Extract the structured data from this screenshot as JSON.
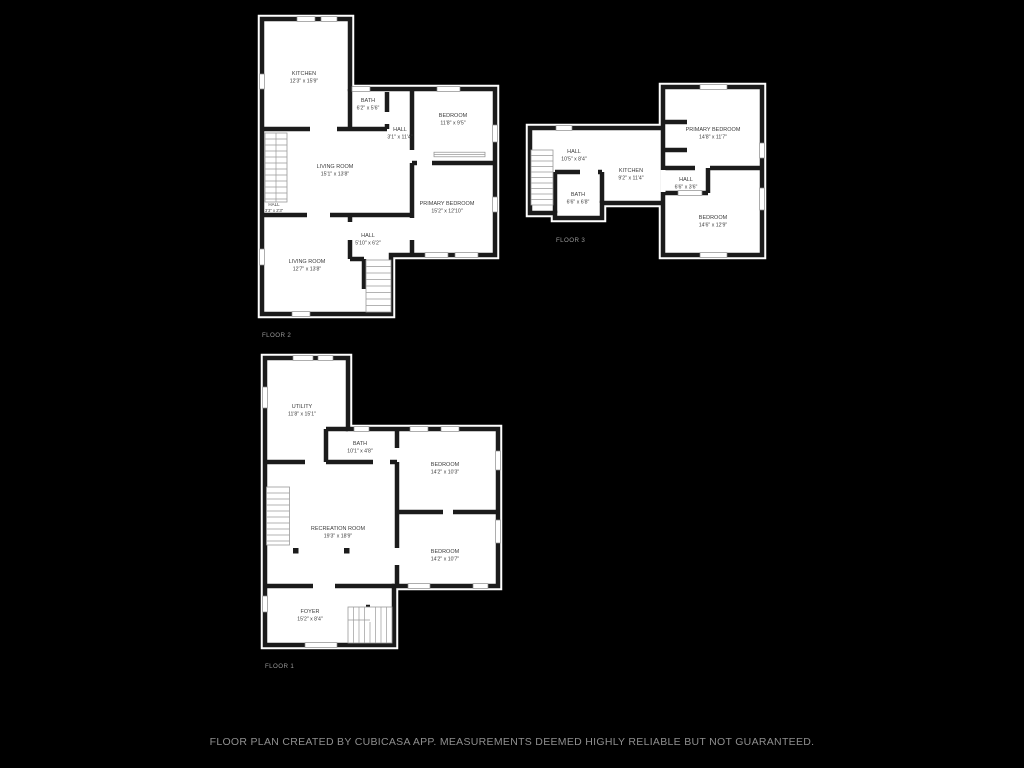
{
  "colors": {
    "background": "#000000",
    "plan_fill": "#ffffff",
    "wall": "#1b1b1b",
    "room_text": "#3c3c3c",
    "floor_label_text": "#9a9a9a",
    "footer_text": "#8f8f8f"
  },
  "floors": [
    {
      "label": "FLOOR 2",
      "rooms": [
        {
          "name": "KITCHEN",
          "dims": "12'3\" x 15'9\""
        },
        {
          "name": "BATH",
          "dims": "6'2\" x 5'6\""
        },
        {
          "name": "HALL",
          "dims": "3'1\" x 11'4\""
        },
        {
          "name": "BEDROOM",
          "dims": "11'8\" x 9'5\""
        },
        {
          "name": "LIVING ROOM",
          "dims": "15'1\" x 13'8\""
        },
        {
          "name": "PRIMARY BEDROOM",
          "dims": "15'2\" x 12'10\""
        },
        {
          "name": "HALL",
          "dims": "3'3\" x 2'3\""
        },
        {
          "name": "HALL",
          "dims": "5'10\" x 6'2\""
        },
        {
          "name": "LIVING ROOM",
          "dims": "12'7\" x 13'8\""
        }
      ]
    },
    {
      "label": "FLOOR 3",
      "rooms": [
        {
          "name": "HALL",
          "dims": "10'5\" x 8'4\""
        },
        {
          "name": "KITCHEN",
          "dims": "9'2\" x 11'4\""
        },
        {
          "name": "PRIMARY BEDROOM",
          "dims": "14'8\" x 11'7\""
        },
        {
          "name": "BATH",
          "dims": "6'6\" x 6'8\""
        },
        {
          "name": "HALL",
          "dims": "6'6\" x 3'6\""
        },
        {
          "name": "BEDROOM",
          "dims": "14'6\" x 12'9\""
        }
      ]
    },
    {
      "label": "FLOOR 1",
      "rooms": [
        {
          "name": "UTILITY",
          "dims": "11'8\" x 15'1\""
        },
        {
          "name": "BATH",
          "dims": "10'1\" x 4'8\""
        },
        {
          "name": "BEDROOM",
          "dims": "14'2\" x 10'3\""
        },
        {
          "name": "RECREATION ROOM",
          "dims": "19'3\" x 18'9\""
        },
        {
          "name": "BEDROOM",
          "dims": "14'2\" x 10'7\""
        },
        {
          "name": "FOYER",
          "dims": "15'2\" x 8'4\""
        }
      ]
    }
  ],
  "footer": {
    "text": "FLOOR PLAN CREATED BY CUBICASA APP. MEASUREMENTS DEEMED HIGHLY RELIABLE BUT NOT GUARANTEED."
  }
}
